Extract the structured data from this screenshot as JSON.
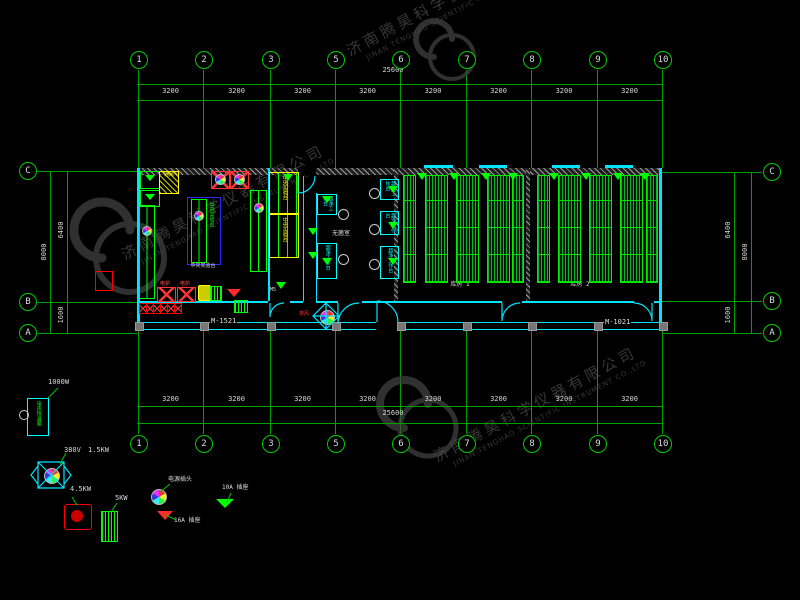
{
  "colors": {
    "grid_green": "#00b300",
    "object_green": "#00ff00",
    "wall_cyan": "#00e5ff",
    "accent_yellow": "#ffff00",
    "accent_red": "#ff2a2a",
    "bench_blue": "#2a2aff",
    "text_white": "#dddddd",
    "watermark_gray": "#4a4a4a",
    "background": "#000000"
  },
  "watermark": {
    "cn": "济南腾昊科学仪器有限公司",
    "en": "JINAN TENGHAO SCIENTIFIC INSTRUMENT CO.,LTD"
  },
  "grid": {
    "top_labels": [
      "1",
      "2",
      "3",
      "5",
      "6",
      "7",
      "8",
      "9",
      "10"
    ],
    "bottom_labels": [
      "1",
      "2",
      "3",
      "5",
      "6",
      "7",
      "8",
      "9",
      "10"
    ],
    "side_labels": [
      "C",
      "B",
      "A"
    ],
    "bay_dim": "3200",
    "total_dim": "25600",
    "side_total": "8000",
    "side_upper": "6400",
    "side_lower": "1600"
  },
  "plan": {
    "door_left": "M-1521",
    "door_right": "M-1021",
    "passage_tag": "M5",
    "fan_tag": "排风",
    "room_sterile": "无菌室",
    "room_store1": "库房 1",
    "room_store2": "库房 2",
    "bench_central": "中央实验台",
    "bench_caption": "中央实验台",
    "bench_clean": "超净工作台",
    "fume_label": "通风",
    "stove_label": "电炉"
  },
  "legend": {
    "incubator_name": "电热恒温箱",
    "incubator_power": "1000W",
    "fan_voltage": "380V",
    "fan_power": "1.5KW",
    "stove_power": "4.5KW",
    "rack_power": "5KW",
    "socket_name": "电源插头",
    "socket_red": "16A 插座",
    "socket_green": "10A 插座"
  }
}
